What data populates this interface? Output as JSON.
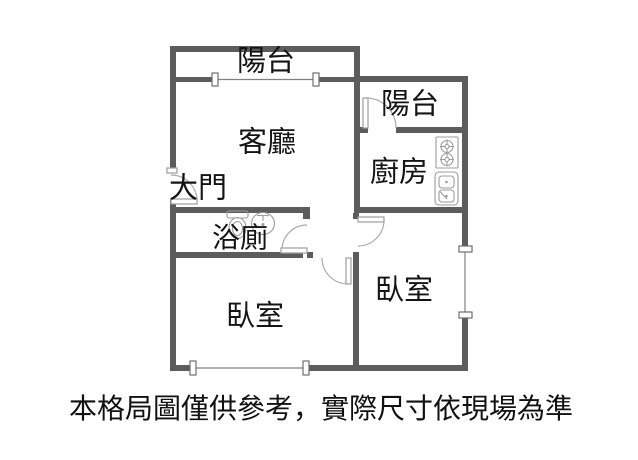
{
  "colors": {
    "wall": "#5c5c5c",
    "fixture_line": "#9c9c9c",
    "text": "#141414"
  },
  "rooms": {
    "balcony_top": {
      "label": "陽台"
    },
    "balcony_right": {
      "label": "陽台"
    },
    "living_room": {
      "label": "客廳"
    },
    "kitchen": {
      "label": "廚房"
    },
    "entrance": {
      "label": "大門"
    },
    "bathroom": {
      "label": "浴廁"
    },
    "bedroom_right": {
      "label": "臥室"
    },
    "bedroom_bottom": {
      "label": "臥室"
    }
  },
  "fixtures": [
    {
      "icon": "stove-icon",
      "room": "kitchen"
    },
    {
      "icon": "sink-icon",
      "room": "kitchen"
    },
    {
      "icon": "toilet-icon",
      "room": "bathroom"
    },
    {
      "icon": "washbasin-icon",
      "room": "bathroom"
    }
  ],
  "caption": "本格局圖僅供參考，實際尺寸依現場為準"
}
